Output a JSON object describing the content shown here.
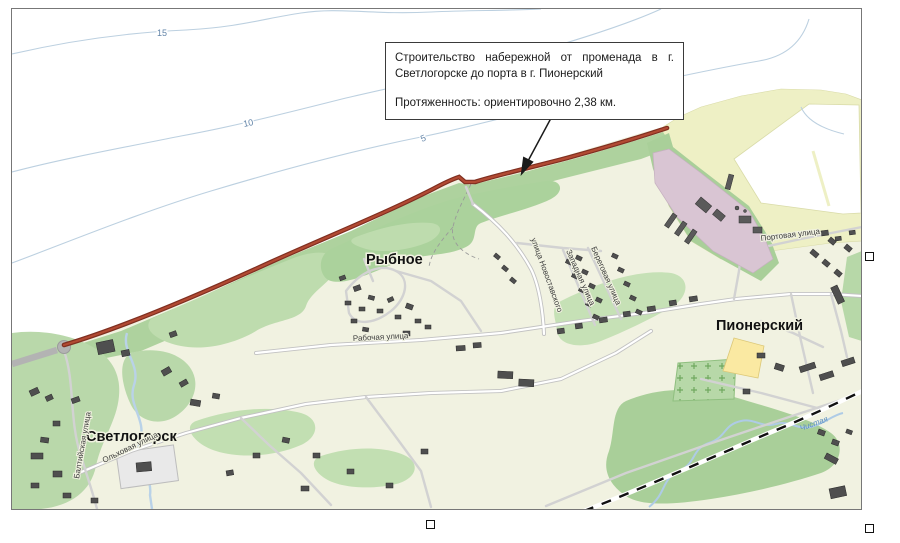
{
  "annotation": {
    "line1": "Строительство набережной от променада в г. Светлогорске до порта в г. Пионерский",
    "line2": "Протяженность: ориентировочно 2,38 км."
  },
  "map": {
    "towns": {
      "rybnoe": "Рыбное",
      "svetlogorsk": "Светлогорск",
      "pionersky": "Пионерский"
    },
    "streets": {
      "rabochaya": "Рабочая улица",
      "novostavskogo": "улица Новоставского",
      "zapadnaya": "Западная улица",
      "beregovaya": "Береговая улица",
      "portovaya": "Портовая улица",
      "baltiyskaya": "Балтийская улица",
      "olkhovaya": "Ольховая улица"
    },
    "river": "Чистая",
    "depth_contours": {
      "c15": "15",
      "c10": "10",
      "c5": "5"
    }
  },
  "colors": {
    "route_red": "#a03b2a",
    "sea_white": "#ffffff",
    "land_cream": "#f1f2e1",
    "forest_green": "#aed29e",
    "light_green": "#c2dfb2",
    "industrial_purple": "#d9c5d3",
    "beach_yellow": "#eef0c5",
    "field_yellow": "#fae9a2",
    "contour_blue": "#bcd0e0",
    "water_blue": "#aecbe6",
    "building_gray": "#4f4f4f",
    "road_gray": "#c9c9c9"
  }
}
